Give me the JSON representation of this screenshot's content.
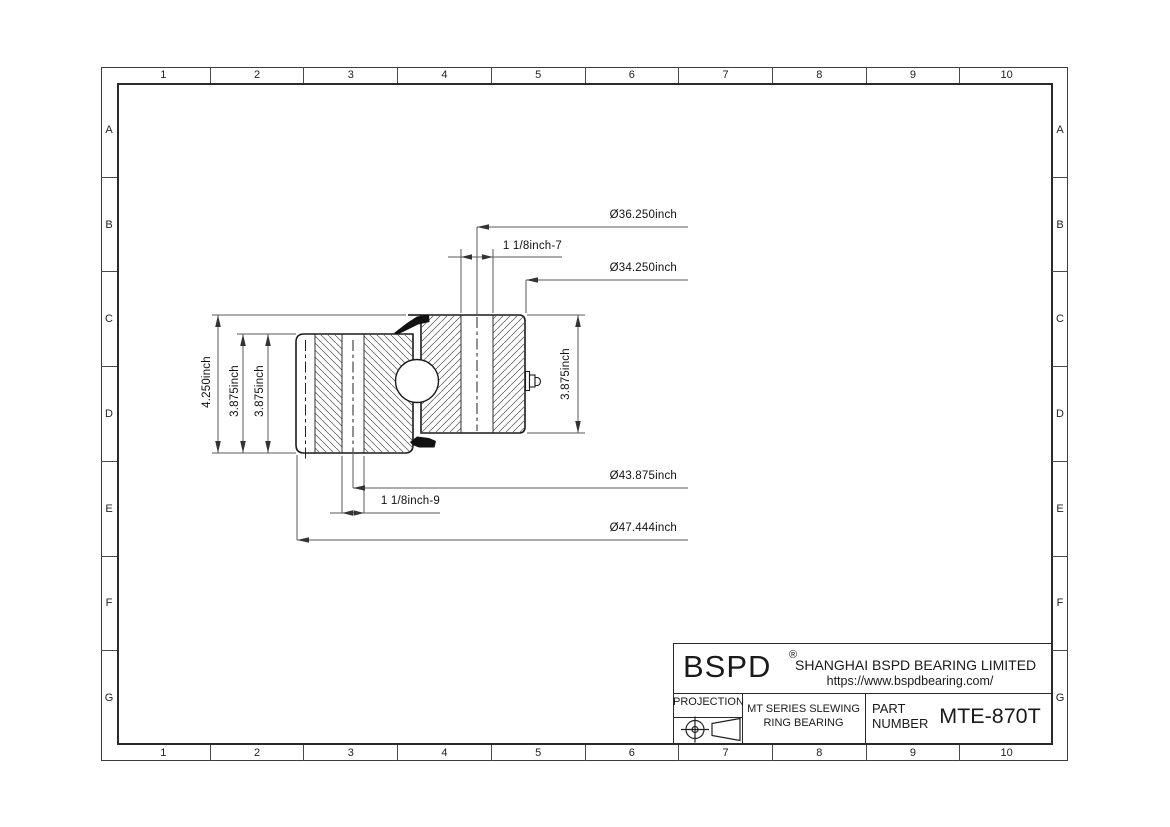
{
  "frame": {
    "columns": [
      "1",
      "2",
      "3",
      "4",
      "5",
      "6",
      "7",
      "8",
      "9",
      "10"
    ],
    "rows": [
      "A",
      "B",
      "C",
      "D",
      "E",
      "F",
      "G"
    ]
  },
  "title_block": {
    "brand": "BSPD",
    "reg_mark": "®",
    "company": "SHANGHAI BSPD BEARING LIMITED",
    "website": "https://www.bspdbearing.com/",
    "projection_label": "PROJECTION",
    "series_line1": "MT SERIES SLEWING",
    "series_line2": "RING BEARING",
    "part_label_line1": "PART",
    "part_label_line2": "NUMBER",
    "part_number": "MTE-870T"
  },
  "drawing": {
    "dims": {
      "inner_bolt_circle": "Ø36.250inch",
      "inner_hole_thread": "1 1/8inch-7",
      "bore_diameter": "Ø34.250inch",
      "overall_height": "4.250inch",
      "outer_ring_height_a": "3.875inch",
      "outer_ring_height_b": "3.875inch",
      "inner_ring_height": "3.875inch",
      "outer_bolt_circle": "Ø43.875inch",
      "outer_hole_thread": "1 1/8inch-9",
      "outer_diameter": "Ø47.444inch"
    }
  }
}
